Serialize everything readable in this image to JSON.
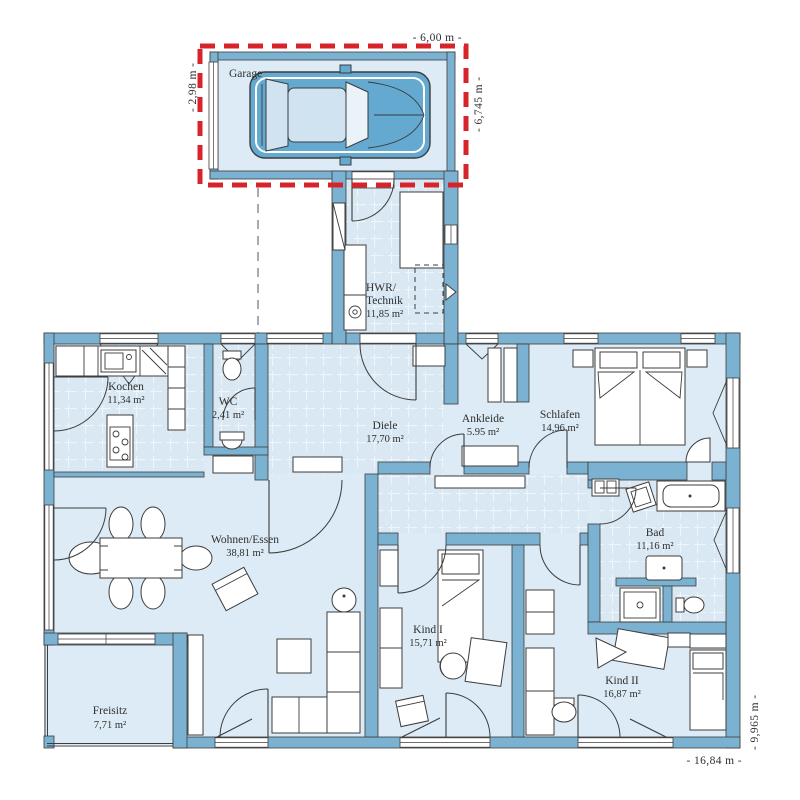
{
  "plan": {
    "title": "Bungalow floor plan",
    "rooms": [
      {
        "id": "garage",
        "label": "Garage",
        "area": ""
      },
      {
        "id": "hwr",
        "label": "HWR/",
        "label2": "Technik",
        "area": "11,85 m²"
      },
      {
        "id": "kochen",
        "label": "Kochen",
        "area": "11,34 m²"
      },
      {
        "id": "wc",
        "label": "WC",
        "area": "2,41 m²"
      },
      {
        "id": "diele",
        "label": "Diele",
        "area": "17,70 m²"
      },
      {
        "id": "ankleide",
        "label": "Ankleide",
        "area": "5.95 m²"
      },
      {
        "id": "schlafen",
        "label": "Schlafen",
        "area": "14,96 m²"
      },
      {
        "id": "bad",
        "label": "Bad",
        "area": "11,16 m²"
      },
      {
        "id": "wohnen",
        "label": "Wohnen/Essen",
        "area": "38,81 m²"
      },
      {
        "id": "kind1",
        "label": "Kind I",
        "area": "15,71 m²"
      },
      {
        "id": "kind2",
        "label": "Kind II",
        "area": "16,87 m²"
      },
      {
        "id": "freisitz",
        "label": "Freisitz",
        "area": "7,71 m²"
      }
    ],
    "dimensions": {
      "garage_width": "- 6,00 m -",
      "garage_depth_left": "- 2,98 m -",
      "garage_depth_right": "- 6,745 m -",
      "house_width": "- 16,84 m -",
      "house_depth": "- 9,965 m -"
    },
    "colors": {
      "wall": "#7cb2d1",
      "wall_outline": "#3c3c3c",
      "floor": "#dcebf5",
      "red_dashed": "#d7242b",
      "text": "#2f2f2f",
      "car_body": "#64a9d0",
      "car_glass": "#cfe4f0"
    }
  }
}
